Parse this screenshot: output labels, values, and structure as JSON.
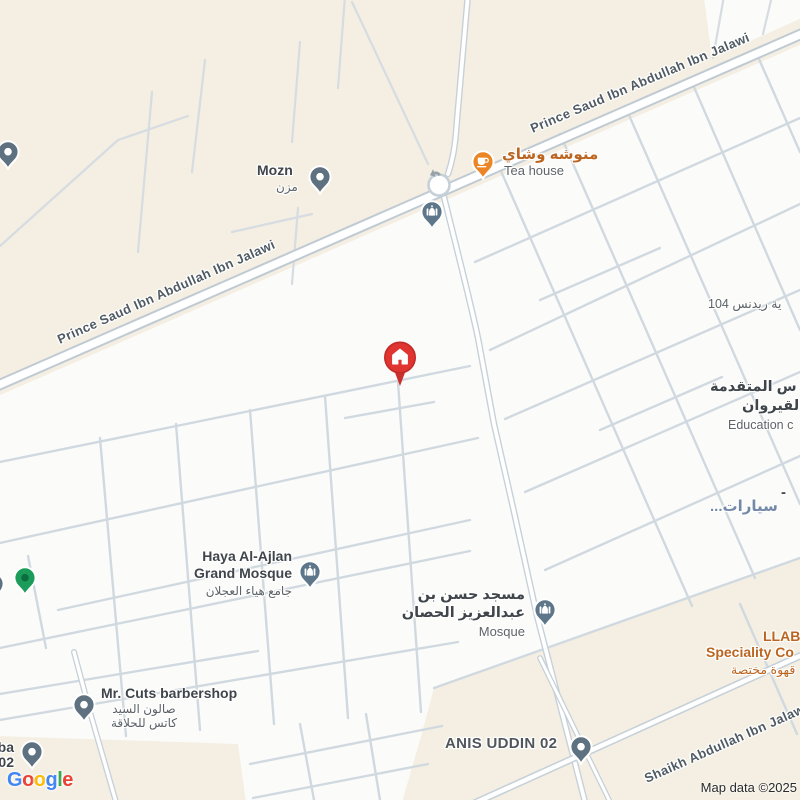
{
  "attribution": "Map data ©2025",
  "google_logo_letters": [
    "G",
    "o",
    "o",
    "g",
    "l",
    "e"
  ],
  "road_labels": {
    "prince_saud": "Prince Saud Ibn Abdullah Ibn Jalawi",
    "shaikh_abdullah": "Shaikh Abdullah Ibn Jalawi"
  },
  "pois": {
    "mozn": {
      "name": "Mozn",
      "name_ar": "مزن",
      "icon": "place-pin"
    },
    "tea_house": {
      "name_ar": "منوشه وشاي",
      "name": "Tea house",
      "icon": "coffee-cup-pin"
    },
    "haya_mosque": {
      "name_line1": "Haya Al-Ajlan",
      "name_line2": "Grand Mosque",
      "name_ar": "جامع هياء العجلان",
      "icon": "mosque-pin"
    },
    "hassan_mosque": {
      "name_ar_line1": "مسجد حسن بن",
      "name_ar_line2": "عبدالعزيز الحصان",
      "category": "Mosque",
      "icon": "mosque-pin"
    },
    "unnamed_mosque": {
      "icon": "mosque-pin"
    },
    "mr_cuts": {
      "name": "Mr. Cuts barbershop",
      "name_ar_line1": "صالون السيد",
      "name_ar_line2": "كاتس للحلاقة",
      "icon": "place-pin"
    },
    "anis_uddin": {
      "name": "ANIS UDDIN 02",
      "icon": "place-pin"
    },
    "llab": {
      "name_line1": "LLAB",
      "name_line2": "Speciality Co",
      "name_ar": "قهوة مختصة"
    },
    "residence_104": {
      "name_ar": "ية ريدنس 104"
    },
    "education": {
      "name_ar_line1": "س المتقدمة",
      "name_ar_line2": "القيروان",
      "name_en": "Education c"
    },
    "cars": {
      "prefix": "-",
      "name_ar": "سيارات..."
    },
    "edge_ba02": {
      "line1": "ba",
      "line2": "02",
      "icon": "place-pin"
    },
    "green_poi": {
      "icon": "green-pin"
    },
    "edge_top_left_poi": {
      "icon": "place-pin"
    },
    "destination": {
      "icon": "red-house-marker"
    }
  },
  "colors": {
    "background_beige": "#F4EFE2",
    "urban_block": "#FBFBFA",
    "road_casing": "#C6D0D8",
    "marker_red": "#DF3430",
    "poi_orange": "#BC6520",
    "poi_green": "#1C9C5B",
    "pin_slate": "#5E7180",
    "mosque_pin": "#5D7689",
    "road_label_gray": "#4F5A63",
    "cars_blue": "#7389A7"
  }
}
